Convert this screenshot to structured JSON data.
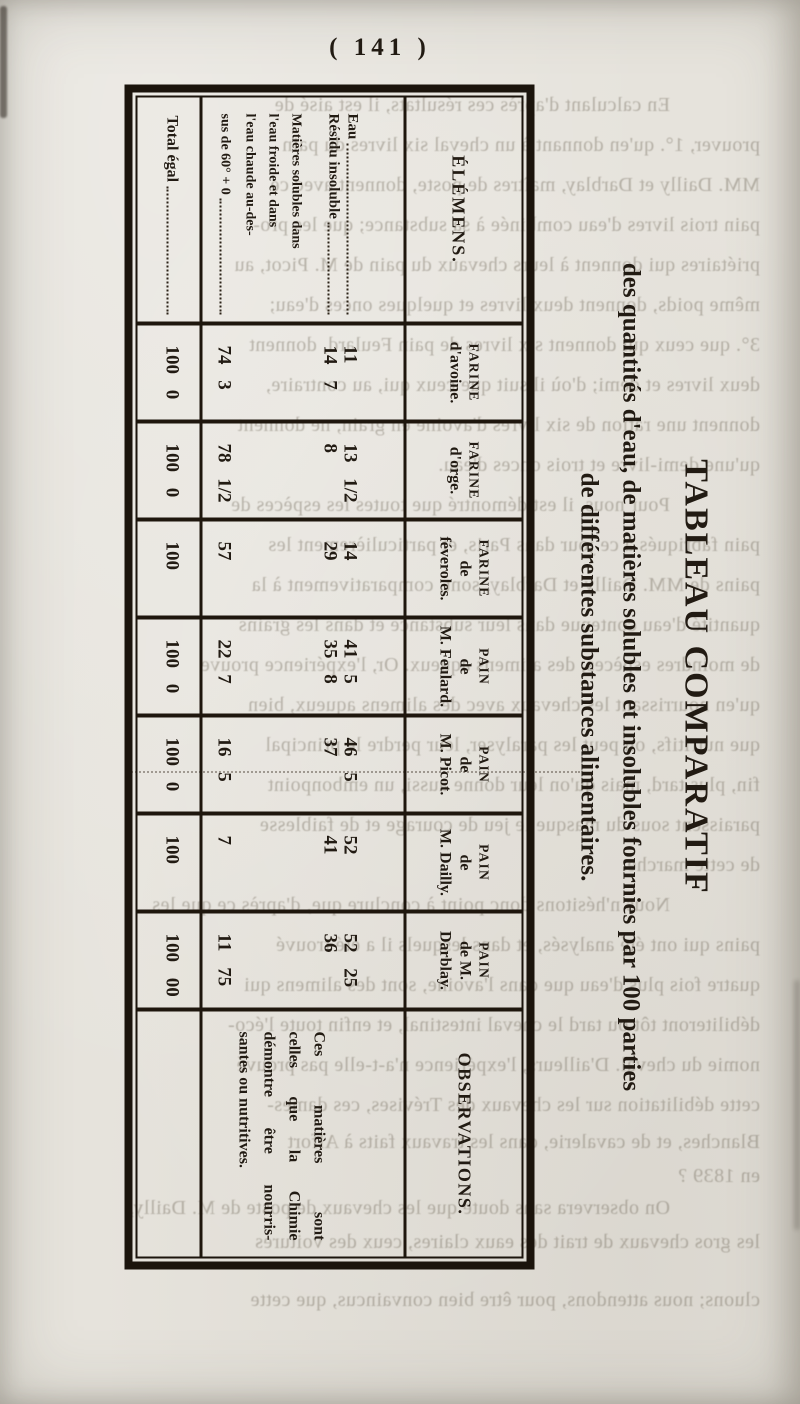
{
  "page": {
    "number": "( 141 )"
  },
  "title": {
    "main": "TABLEAU COMPARATIF",
    "subtitle_line1": "des quantités d'eau, de matières solubles et insolubles fournies par 100 parties",
    "subtitle_line2": "de différentes substances alimentaires."
  },
  "table": {
    "elements_header": "ÉLÉMENS.",
    "row_labels": {
      "eau": "Eau",
      "residu": "Résidu insoluble",
      "matieres_line1": "Matières solubles dans",
      "matieres_line2": "l'eau froide et dans",
      "matieres_line3": "l'eau chaude au-des-",
      "matieres_line4": "sus de 60° + 0",
      "total": "Total égal"
    },
    "columns": [
      {
        "h1": "FARINE",
        "h2": "d'avoine.",
        "h3": "",
        "eau": "11",
        "residu": "14 7",
        "matieres": "74 3",
        "total": "100 0"
      },
      {
        "h1": "FARINE",
        "h2": "d'orge.",
        "h3": "",
        "eau": "13 1/2",
        "residu": "8",
        "matieres": "78 1/2",
        "total": "100 0"
      },
      {
        "h1": "FARINE",
        "h2": "de",
        "h3": "féveroles.",
        "eau": "14",
        "residu": "29",
        "matieres": "57",
        "total": "100"
      },
      {
        "h1": "PAIN",
        "h2": "de",
        "h3": "M. Feulard.",
        "eau": "41 5",
        "residu": "35 8",
        "matieres": "22 7",
        "total": "100 0"
      },
      {
        "h1": "PAIN",
        "h2": "de",
        "h3": "M. Picot.",
        "eau": "46 5",
        "residu": "37",
        "matieres": "16 5",
        "total": "100 0"
      },
      {
        "h1": "PAIN",
        "h2": "de",
        "h3": "M. Dailly.",
        "eau": "52",
        "residu": "41",
        "matieres": "7",
        "total": "100"
      },
      {
        "h1": "PAIN",
        "h2": "de M.",
        "h3": "Darblay.",
        "eau": "52 25",
        "residu": "36",
        "matieres": "11 75",
        "total": "100 00"
      }
    ],
    "observations": {
      "header": "OBSERVATIONS.",
      "line1": "Ces matières sont",
      "line2": "celles que la Chimie",
      "line3": "démontre être nourris-",
      "line4": "santes ou nutritives."
    }
  },
  "ghost": {
    "lines": [
      {
        "y": 93,
        "x": 130,
        "t": "En calculant d'après ces résultats, il est aisé de"
      },
      {
        "y": 133,
        "x": 40,
        "t": "prouver, 1°. qu'en donnant à un cheval six livres du pain"
      },
      {
        "y": 173,
        "x": 40,
        "t": "MM. Dailly et Darblay, maîtres de poste, donnent avec ce"
      },
      {
        "y": 213,
        "x": 40,
        "t": "pain trois livres d'eau combinée à sa substance; que les pro-"
      },
      {
        "y": 253,
        "x": 40,
        "t": "priétaires qui donnent à leurs chevaux du pain de M. Picot, au"
      },
      {
        "y": 293,
        "x": 40,
        "t": "même poids, donnent deux livres et quelques onces d'eau;"
      },
      {
        "y": 333,
        "x": 40,
        "t": "3°. que ceux qui donnent six livres de pain Feulard, donnent"
      },
      {
        "y": 373,
        "x": 40,
        "t": "deux livres et demi; d'où il suit que ceux qui, au contraire,"
      },
      {
        "y": 413,
        "x": 40,
        "t": "donnent une ration de six livres d'avoine en grain, ne donnent"
      },
      {
        "y": 453,
        "x": 40,
        "t": "qu'une demi-livre et trois onces d'eau."
      },
      {
        "y": 493,
        "x": 130,
        "t": "Pour nous, il est démontré que toutes les espèces de"
      },
      {
        "y": 533,
        "x": 40,
        "t": "pain fabriqués à ce jour dans Paris, et particulièrement les"
      },
      {
        "y": 573,
        "x": 40,
        "t": "pains de MM. Dailly et Darblay, sont, comparativement à la"
      },
      {
        "y": 613,
        "x": 40,
        "t": "quantité d'eau contenue dans leur substance et dans les grains"
      },
      {
        "y": 653,
        "x": 40,
        "t": "de moindres espèces, des alimens aqueux. Or, l'expérience prouve"
      },
      {
        "y": 693,
        "x": 40,
        "t": "qu'en nourrissant les chevaux avec des alimens aqueux, bien"
      },
      {
        "y": 733,
        "x": 40,
        "t": "que nutritifs, on peut les paralyser, leur perdre le principal"
      },
      {
        "y": 773,
        "x": 40,
        "t": "fin, plus tard, mais qu'on leur donne aussi, un embonpoint"
      },
      {
        "y": 813,
        "x": 40,
        "t": "paraissent sous du masque le jeu de courage et de faiblesse"
      },
      {
        "y": 853,
        "x": 40,
        "t": "de cette marche."
      },
      {
        "y": 893,
        "x": 130,
        "t": "Nous n'hésitons donc point à conclure que, d'après ce que les"
      },
      {
        "y": 933,
        "x": 40,
        "t": "pains qui ont été analysés, et dans lesquels il a été trouvé"
      },
      {
        "y": 973,
        "x": 40,
        "t": "quatre fois plus d'eau que dans l'avoine, sont des alimens qui"
      },
      {
        "y": 1013,
        "x": 40,
        "t": "débiliteront tôt ou tard le cheval intestinal, et enfin toute l'éco-"
      },
      {
        "y": 1053,
        "x": 40,
        "t": "nomie du cheval. D'ailleurs, l'expérience n'a-t-elle pas prouvé"
      },
      {
        "y": 1093,
        "x": 40,
        "t": "cette débilitation sur les chevaux des Trévises, ces dames-"
      },
      {
        "y": 1130,
        "x": 40,
        "t": "Blanches, et de cavalerie, dans les travaux faits à Alfort"
      },
      {
        "y": 1164,
        "x": 40,
        "t": "en 1839 ?"
      },
      {
        "y": 1196,
        "x": 130,
        "t": "On observera sans doute que les chevaux de poste de M. Dailly,"
      },
      {
        "y": 1230,
        "x": 40,
        "t": "les gros chevaux de trait des eaux claires, ceux des voitures"
      },
      {
        "y": 1288,
        "x": 40,
        "t": "cluons; nous attendons, pour être bien convaincus, que cette"
      }
    ]
  }
}
